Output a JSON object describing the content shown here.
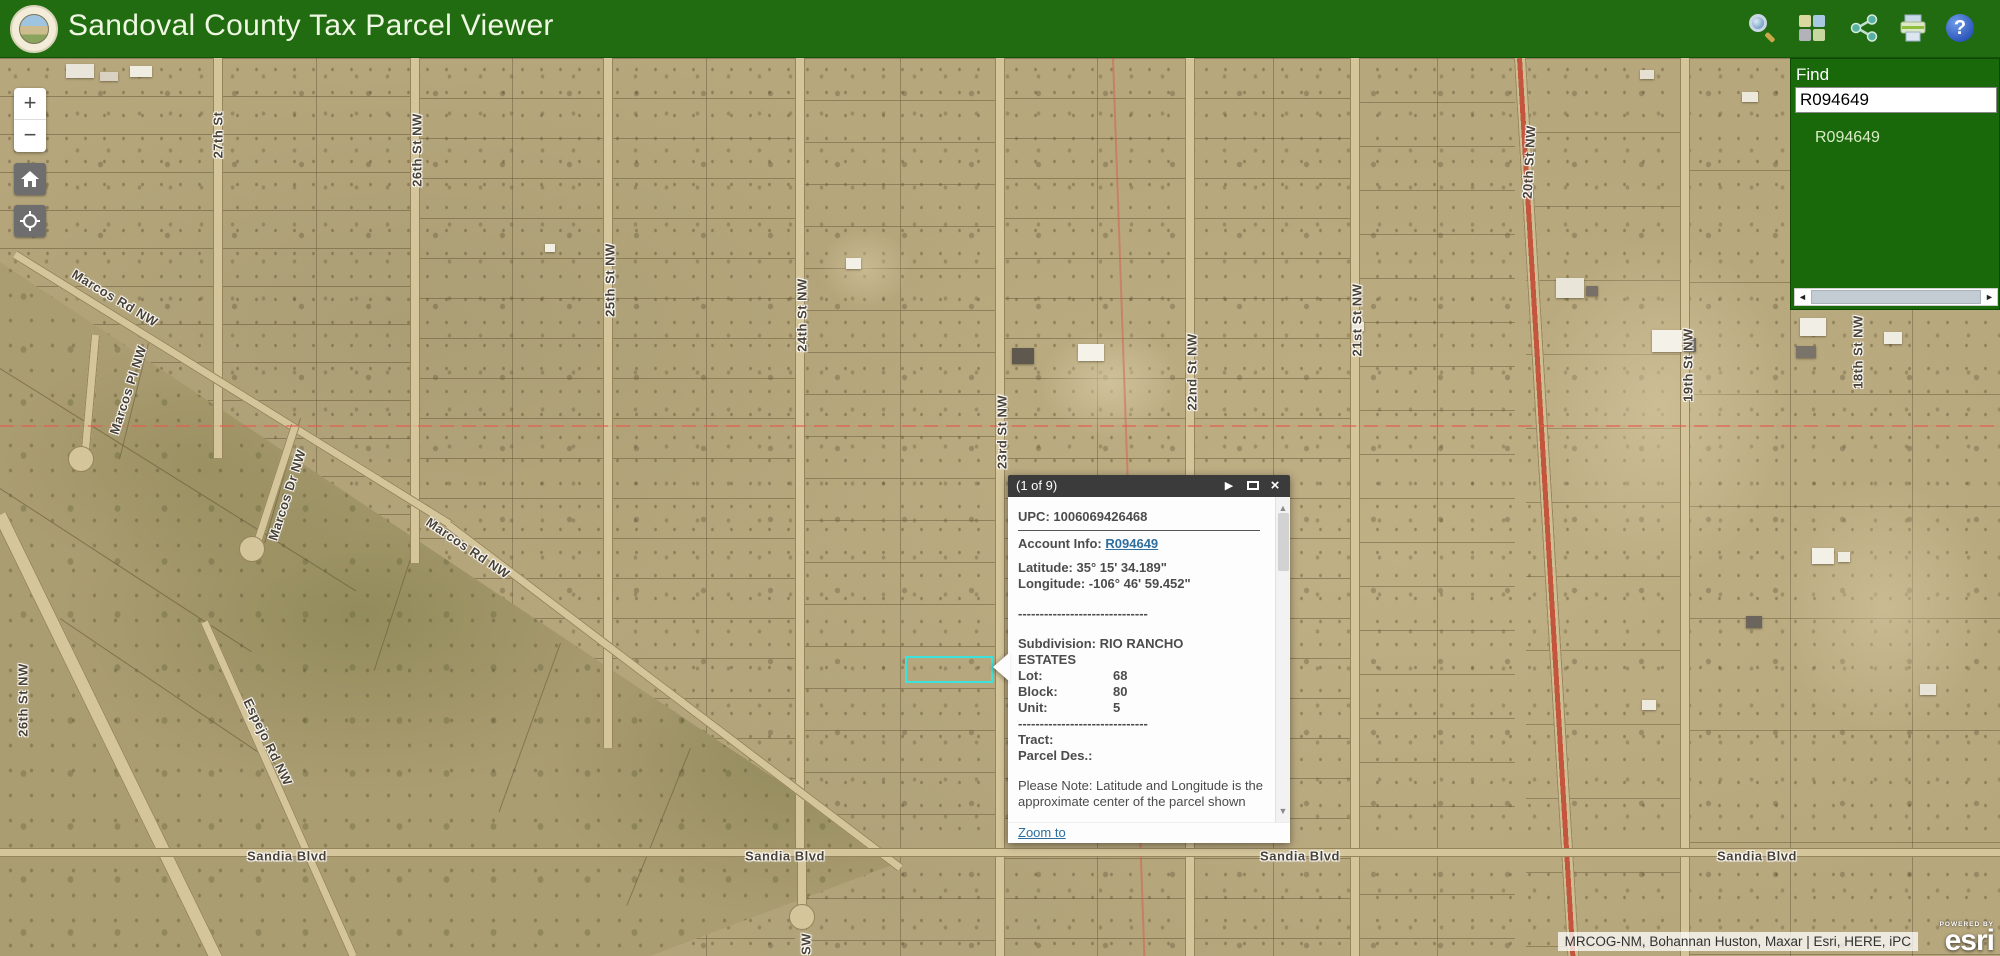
{
  "header": {
    "title": "Sandoval County Tax Parcel Viewer",
    "icons": [
      "search",
      "basemap-gallery",
      "share",
      "print",
      "help"
    ],
    "help_glyph": "?"
  },
  "controls": {
    "zoom_in": "+",
    "zoom_out": "−"
  },
  "find_panel": {
    "label": "Find",
    "input_value": "R094649",
    "result": "R094649",
    "scroll_left": "◄",
    "scroll_right": "►"
  },
  "popup": {
    "title": "(1 of 9)",
    "next_glyph": "▶",
    "close_glyph": "×",
    "upc": "UPC: 1006069426468",
    "account_label": "Account Info: ",
    "account_link": "R094649",
    "latitude": "Latitude: 35° 15' 34.189\"",
    "longitude": "Longitude: -106° 46' 59.452\"",
    "separator1": "------------------------------",
    "subdivision": "Subdivision: RIO RANCHO ESTATES",
    "fields": [
      {
        "label": "Lot:",
        "value": "68"
      },
      {
        "label": "Block:",
        "value": "80"
      },
      {
        "label": "Unit:",
        "value": "5"
      }
    ],
    "separator2": "------------------------------",
    "tract": "Tract:",
    "parcel_des": "Parcel Des.:",
    "note": "Please Note: Latitude and Longitude is the approximate center of the parcel shown",
    "zoom_to": "Zoom to",
    "scroll_up": "▲",
    "scroll_down": "▼"
  },
  "map": {
    "highlight_color": "#3ce3dd",
    "street_labels": [
      {
        "text": "27th St",
        "x": 218,
        "y": 77,
        "rot": -90
      },
      {
        "text": "26th St NW",
        "x": 417,
        "y": 92,
        "rot": -90
      },
      {
        "text": "25th St NW",
        "x": 610,
        "y": 222,
        "rot": -90
      },
      {
        "text": "24th St NW",
        "x": 802,
        "y": 257,
        "rot": -90
      },
      {
        "text": "23rd St NW",
        "x": 1002,
        "y": 374,
        "rot": -90
      },
      {
        "text": "22nd St NW",
        "x": 1192,
        "y": 314,
        "rot": -90
      },
      {
        "text": "21st St NW",
        "x": 1357,
        "y": 262,
        "rot": -90
      },
      {
        "text": "20th St NW",
        "x": 1529,
        "y": 104,
        "rot": -87
      },
      {
        "text": "19th St NW",
        "x": 1688,
        "y": 307,
        "rot": -90
      },
      {
        "text": "18th St NW",
        "x": 1858,
        "y": 294,
        "rot": -90
      },
      {
        "text": "26th St NW",
        "x": 23,
        "y": 642,
        "rot": -90
      },
      {
        "text": "Marcos Rd NW",
        "x": 115,
        "y": 240,
        "rot": 31
      },
      {
        "text": "Marcos Pl NW",
        "x": 128,
        "y": 332,
        "rot": -72
      },
      {
        "text": "Marcos Dr NW",
        "x": 287,
        "y": 437,
        "rot": -72
      },
      {
        "text": "Marcos Rd NW",
        "x": 468,
        "y": 490,
        "rot": 34
      },
      {
        "text": "Espejo Rd NW",
        "x": 268,
        "y": 684,
        "rot": 64
      },
      {
        "text": "Sandia Blvd",
        "x": 287,
        "y": 798,
        "rot": 0
      },
      {
        "text": "Sandia Blvd",
        "x": 785,
        "y": 798,
        "rot": 0
      },
      {
        "text": "Sandia Blvd",
        "x": 1300,
        "y": 798,
        "rot": 0
      },
      {
        "text": "Sandia Blvd",
        "x": 1757,
        "y": 798,
        "rot": 0
      },
      {
        "text": "SW",
        "x": 806,
        "y": 886,
        "rot": -90
      }
    ]
  },
  "attribution": {
    "sources": "MRCOG-NM, Bohannan Huston, Maxar | Esri, HERE, iPC",
    "powered_by": "POWERED BY",
    "brand": "esri"
  }
}
